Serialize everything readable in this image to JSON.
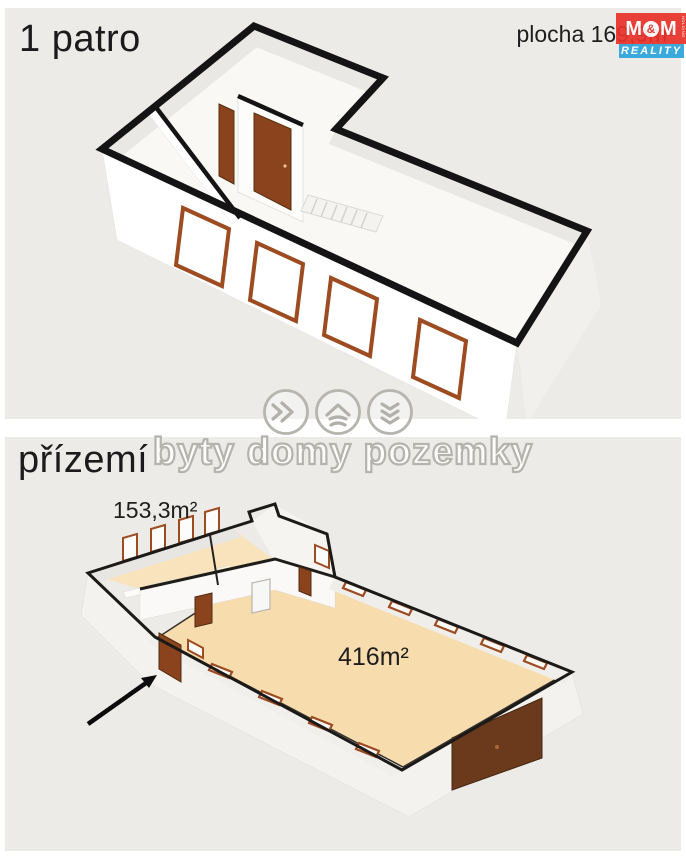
{
  "top_panel": {
    "floor_label": "1 patro",
    "area_label": "plocha 169,9m²"
  },
  "bottom_panel": {
    "floor_label": "přízemí",
    "annex_area_label": "153,3m²",
    "hall_area_label": "416m²"
  },
  "watermark": {
    "text": "byty domy pozemky",
    "icons": [
      "fast-forward-icon",
      "home-icon",
      "chevrons-down-icon"
    ]
  },
  "logo": {
    "m_left": "M",
    "ampersand": "&",
    "m_right": "M",
    "reality": "REALITY",
    "holding": "HOLDING"
  },
  "colors": {
    "panel_bg": "#ECEBE8",
    "floor_peach": "#F7DCAE",
    "annex_floor": "#F8E3BC",
    "door_brown": "#8A431C",
    "garage_brown": "#6B3A1D",
    "window_frame": "#9D4B20",
    "logo_red": "#E8322B",
    "logo_blue": "#2BA4DC",
    "watermark_gray": "#B5B3AE",
    "outline_black": "#141414"
  }
}
